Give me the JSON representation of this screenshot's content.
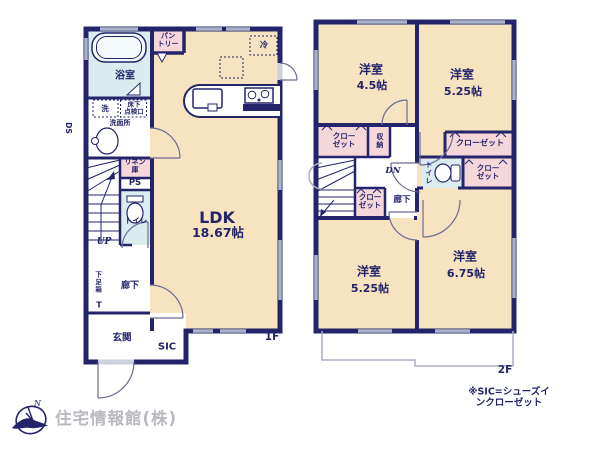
{
  "colors": {
    "wall_navy": "#24246b",
    "room_beige": "#f6e3c0",
    "wet_area_blue": "#dbecf1",
    "closet_pink": "#f5d6d9",
    "window_gray": "#aab3ca",
    "balcony_gray": "#a8aec4",
    "company_text_gray": "#b9b9c0"
  },
  "floor1": {
    "label": "1F",
    "ldk_name": "LDK",
    "ldk_size": "18.67帖",
    "bath": "浴室",
    "pantry": "パン\nトリー",
    "fridge": "冷",
    "washer": "洗",
    "underfloor": "床下\n点検口",
    "washroom": "洗面所",
    "ds": "DS",
    "linen": "リネン\n庫",
    "ps": "PS",
    "toilet": "トイレ",
    "up": "UP",
    "shoebox": "下足箱",
    "shoebox_t": "T",
    "hallway": "廊下",
    "entrance": "玄関",
    "sic": "SIC"
  },
  "floor2": {
    "label": "2F",
    "room_nw_name": "洋室",
    "room_nw_size": "4.5帖",
    "room_ne_name": "洋室",
    "room_ne_size": "5.25帖",
    "room_sw_name": "洋室",
    "room_sw_size": "5.25帖",
    "room_se_name": "洋室",
    "room_se_size": "6.75帖",
    "closet_nw": "クロー\nゼット",
    "storage": "収納",
    "closet_ne": "クローゼット",
    "closet_mid": "クロー\nゼット",
    "closet_e": "クロー\nゼット",
    "toilet": "トイレ",
    "dn": "DN",
    "hallway": "廊下"
  },
  "footer": {
    "note": "※SIC=シューズインクローゼット",
    "company": "住宅情報館(株)",
    "logo_n": "N"
  }
}
